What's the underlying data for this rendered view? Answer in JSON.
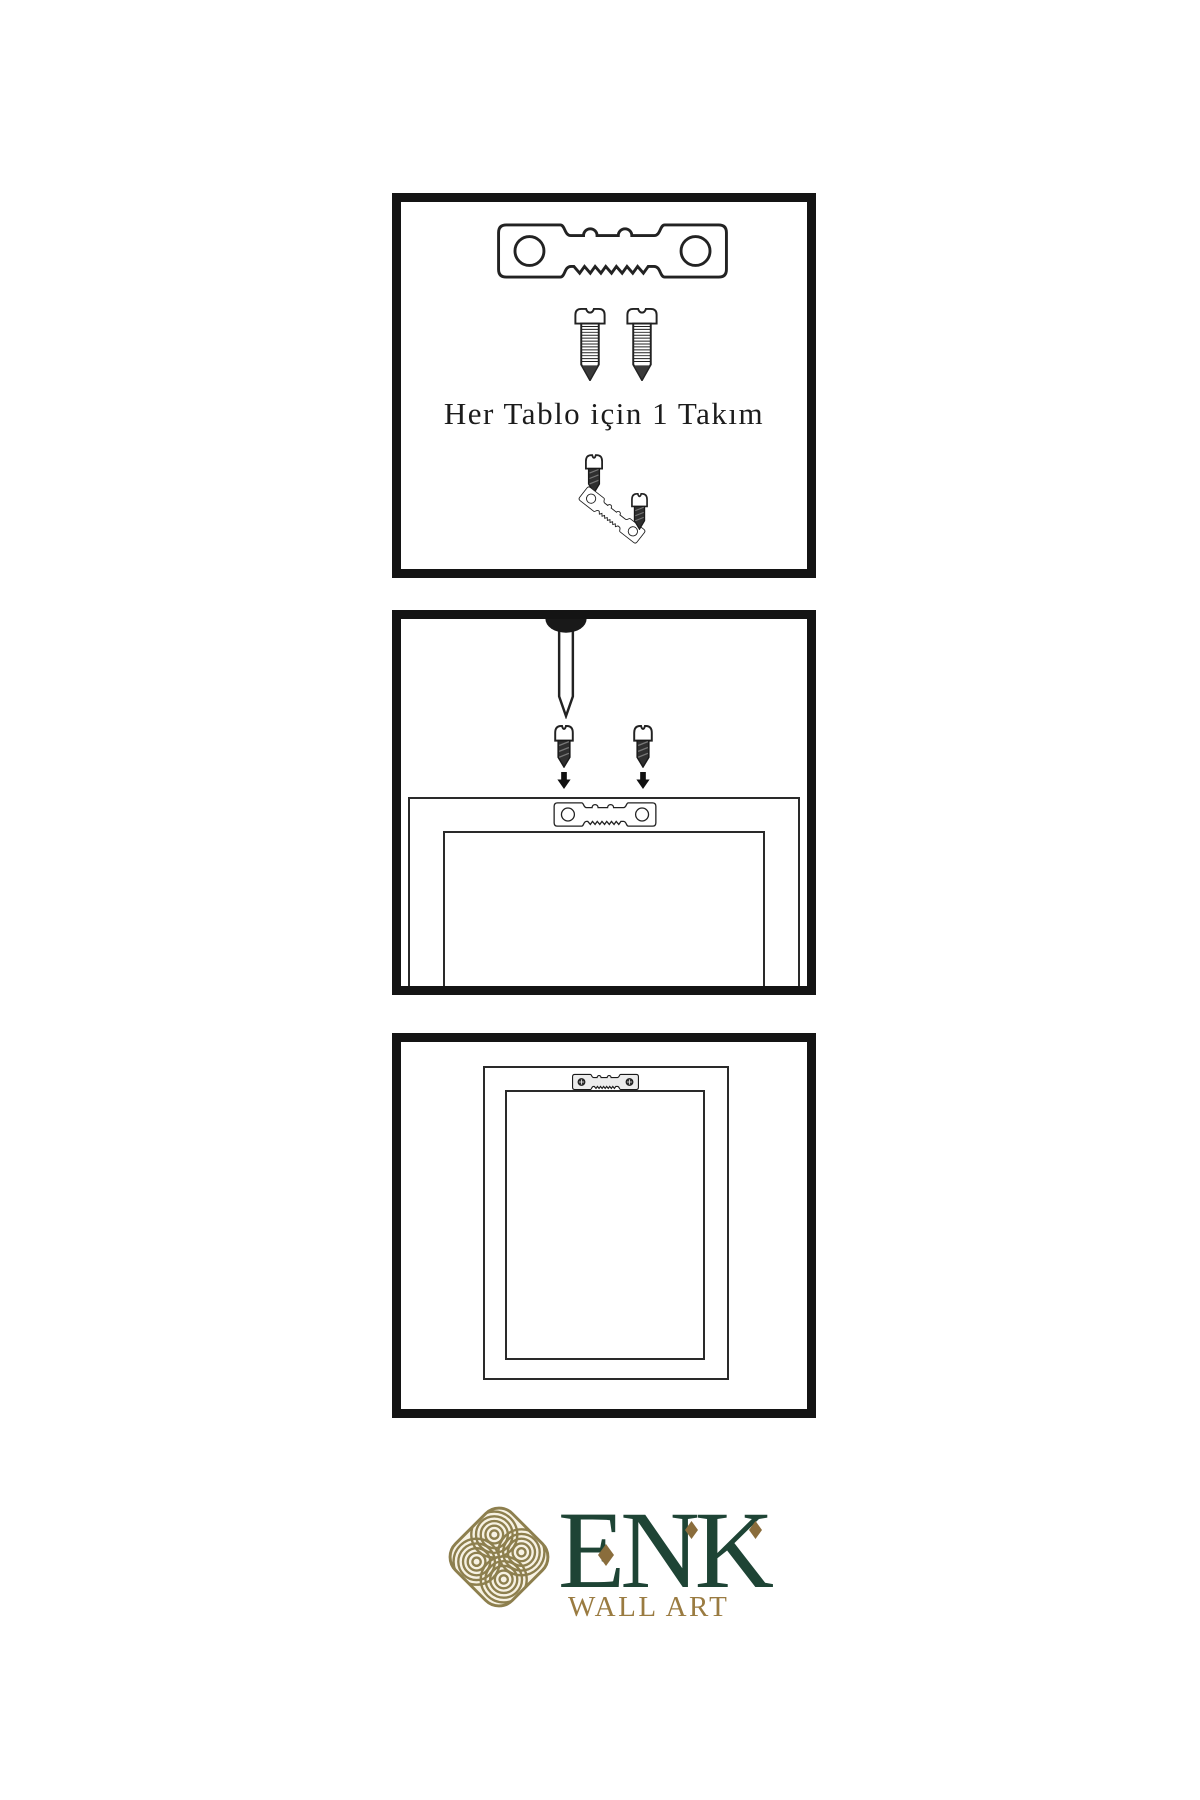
{
  "page": {
    "background": "#ffffff"
  },
  "panels": {
    "panel1": {
      "name": "kit-contents",
      "caption": "Her Tablo için 1 Takım"
    },
    "panel2": {
      "name": "wall-mounting-diagram"
    },
    "panel3": {
      "name": "hung-frame-diagram"
    }
  },
  "logo": {
    "name": "ENK",
    "tagline": "WALL ART"
  },
  "colors": {
    "logo_green": "#1e4435",
    "logo_gold": "#9a7b41",
    "diamond_gold": "#8a6d3c",
    "knot_gold": "#8d7f4e",
    "knot_cream": "#f7f2e3",
    "line_black": "#1a1a1a",
    "panel_border": "#141414"
  },
  "icons": {
    "sawtooth-hanger-icon": "svg-strip-with-teeth",
    "sawtooth-hanger-installed-icon": "svg-strip-with-cross-screws",
    "screw-threaded-icon": "svg-threaded-screw",
    "screw-dark-icon": "svg-dark-screw",
    "nail-icon": "svg-nail-with-dome-head",
    "arrow-down-icon": "▼",
    "knot-logo-icon": "svg-interlaced-knot",
    "diamond-accent-icon": "◆"
  }
}
